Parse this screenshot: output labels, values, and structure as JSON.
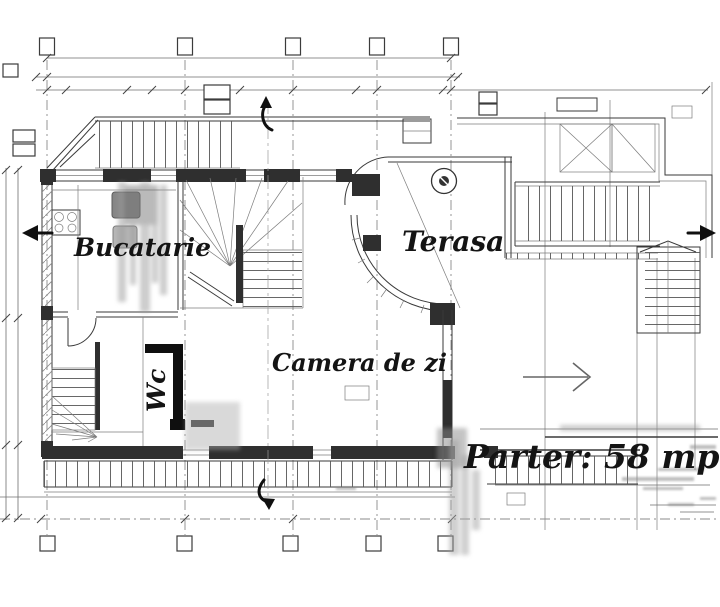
{
  "drawing": {
    "type": "architectural-floor-plan",
    "language": "ro",
    "rooms": [
      {
        "id": "bucatarie",
        "label": "Bucatarie"
      },
      {
        "id": "terasa",
        "label": "Terasa"
      },
      {
        "id": "camera-de-zi",
        "label": "Camera de zi"
      },
      {
        "id": "wc",
        "label": "Wc"
      }
    ],
    "area_label": "Parter: 58 mp",
    "colors": {
      "paper": "#ffffff",
      "ink": "#141414",
      "line": "#3a3a3a",
      "grid": "#8b8b8b",
      "wall": "#2f2f2f",
      "smudge": "#a8a8a8"
    }
  }
}
